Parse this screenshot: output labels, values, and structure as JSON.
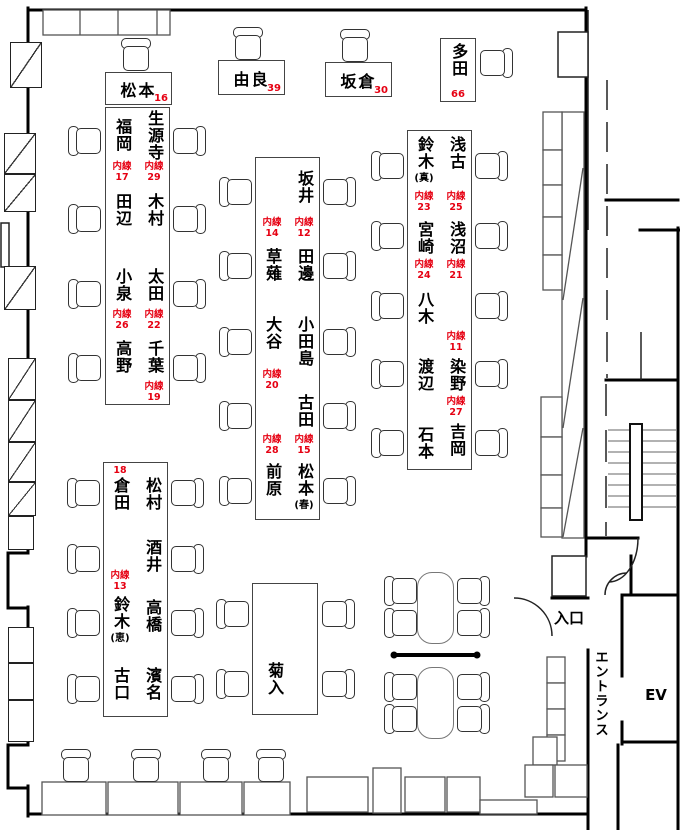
{
  "top_desks": [
    {
      "name": "松本",
      "ext": "16"
    },
    {
      "name": "由良",
      "ext": "39"
    },
    {
      "name": "坂倉",
      "ext": "30"
    },
    {
      "name": "多田",
      "ext": "66"
    }
  ],
  "i1": {
    "seats": [
      {
        "name": "福岡",
        "ext": "内線\n17"
      },
      {
        "name": "生源寺",
        "ext": "内線\n29"
      },
      {
        "name": "田辺"
      },
      {
        "name": "木村"
      },
      {
        "name": "小泉",
        "ext": "内線\n26"
      },
      {
        "name": "太田",
        "ext": "内線\n22"
      },
      {
        "name": "高野"
      },
      {
        "name": "千葉",
        "ext": "内線\n19"
      }
    ]
  },
  "i2": {
    "seats": [
      {
        "name": "坂井",
        "ext": "内線\n12"
      },
      {
        "name": "草薙",
        "ext": "内線\n14"
      },
      {
        "name": "田邊"
      },
      {
        "name": "大谷",
        "ext": "内線\n20"
      },
      {
        "name": "小田島"
      },
      {
        "name": "古田",
        "ext": "内線\n15"
      },
      {
        "name": "前原",
        "ext": "内線\n28"
      },
      {
        "name": "松本",
        "sub": "(春)"
      }
    ]
  },
  "i3": {
    "seats": [
      {
        "name": "鈴木",
        "sub": "(真)",
        "ext": "内線\n23"
      },
      {
        "name": "浅古",
        "ext": "内線\n25"
      },
      {
        "name": "宮崎",
        "ext": "内線\n24"
      },
      {
        "name": "浅沼",
        "ext": "内線\n21"
      },
      {
        "name": "八木"
      },
      {
        "name": "染野",
        "ext": "内線\n11"
      },
      {
        "name": "渡辺"
      },
      {
        "name": "吉岡",
        "ext": "内線\n27"
      },
      {
        "name": "石本"
      }
    ]
  },
  "i4": {
    "seats": [
      {
        "name": "倉田",
        "ext": "18"
      },
      {
        "name": "松村"
      },
      {
        "name": "酒井"
      },
      {
        "name": "鈴木",
        "sub": "(恵)",
        "ext": "内線\n13"
      },
      {
        "name": "高橋"
      },
      {
        "name": "古口"
      },
      {
        "name": "濱名"
      }
    ]
  },
  "tables": {
    "kikuiri": "菊入"
  },
  "entrance": {
    "door": "入口",
    "hall": "エントランス",
    "elevator": "EV"
  },
  "colors": {
    "extension_red": "#e60012"
  }
}
